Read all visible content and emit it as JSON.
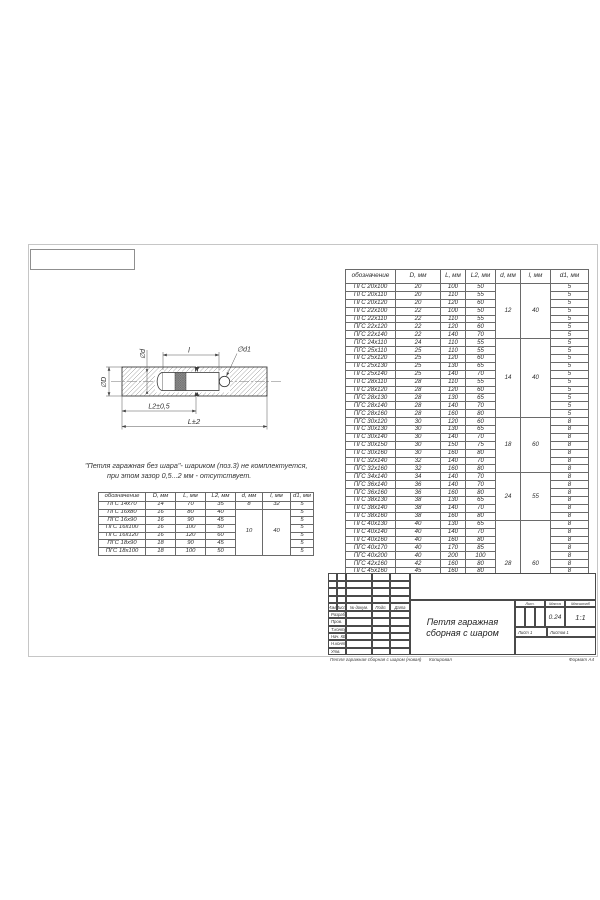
{
  "colors": {
    "line": "#3b3b3b",
    "table_border": "#6a6a6a",
    "hatch": "#8a8a8a",
    "pin_band_fill": "#8f8f8f",
    "sheet_border": "#c6c6c6"
  },
  "drawing": {
    "labels": {
      "dia_d": "∅d",
      "dia_D": "∅D",
      "len_l": "l",
      "dia_d1": "∅d1",
      "l2_dim": "L2±0,5",
      "l_dim": "L±2"
    }
  },
  "note": {
    "line1": "\"Петля гаражная без шара\"- шариком (поз.3) не комплектуется,",
    "line2": "при этом зазор 0,5...2 мм - отсутствует."
  },
  "small_table": {
    "headers": [
      "обозначение",
      "D, мм",
      "L, мм",
      "L2, мм",
      "d, мм",
      "l, мм",
      "d1, мм"
    ],
    "groups": [
      {
        "d": "8",
        "l": "32",
        "rows": [
          [
            "ПГС 14х70",
            "14",
            "70",
            "35",
            "5"
          ]
        ]
      },
      {
        "d": "10",
        "l": "40",
        "rows": [
          [
            "ПГС 16х80",
            "16",
            "80",
            "40",
            "5"
          ],
          [
            "ПГС 16х90",
            "16",
            "90",
            "45",
            "5"
          ],
          [
            "ПГС 16х100",
            "16",
            "100",
            "50",
            "5"
          ],
          [
            "ПГС 16х120",
            "16",
            "120",
            "60",
            "5"
          ],
          [
            "ПГС 18х90",
            "18",
            "90",
            "45",
            "5"
          ],
          [
            "ПГС 18х100",
            "18",
            "100",
            "50",
            "5"
          ]
        ]
      }
    ]
  },
  "main_table": {
    "headers": [
      "обозначение",
      "D, мм",
      "L, мм",
      "L2, мм",
      "d, мм",
      "l, мм",
      "d1, мм"
    ],
    "groups": [
      {
        "d": "12",
        "l": "40",
        "rows": [
          [
            "ПГС 20х100",
            "20",
            "100",
            "50",
            "5"
          ],
          [
            "ПГС 20х110",
            "20",
            "110",
            "55",
            "5"
          ],
          [
            "ПГС 20х120",
            "20",
            "120",
            "60",
            "5"
          ],
          [
            "ПГС 22х100",
            "22",
            "100",
            "50",
            "5"
          ],
          [
            "ПГС 22х110",
            "22",
            "110",
            "55",
            "5"
          ],
          [
            "ПГС 22х120",
            "22",
            "120",
            "60",
            "5"
          ],
          [
            "ПГС 22х140",
            "22",
            "140",
            "70",
            "5"
          ]
        ]
      },
      {
        "d": "14",
        "l": "40",
        "rows": [
          [
            "ПГС 24х110",
            "24",
            "110",
            "55",
            "5"
          ],
          [
            "ПГС 25х110",
            "25",
            "110",
            "55",
            "5"
          ],
          [
            "ПГС 25х120",
            "25",
            "120",
            "60",
            "5"
          ],
          [
            "ПГС 25х130",
            "25",
            "130",
            "65",
            "5"
          ],
          [
            "ПГС 25х140",
            "25",
            "140",
            "70",
            "5"
          ],
          [
            "ПГС 28х110",
            "28",
            "110",
            "55",
            "5"
          ],
          [
            "ПГС 28х120",
            "28",
            "120",
            "60",
            "5"
          ],
          [
            "ПГС 28х130",
            "28",
            "130",
            "65",
            "5"
          ],
          [
            "ПГС 28х140",
            "28",
            "140",
            "70",
            "5"
          ],
          [
            "ПГС 28х160",
            "28",
            "160",
            "80",
            "5"
          ]
        ]
      },
      {
        "d": "18",
        "l": "60",
        "rows": [
          [
            "ПГС 30х120",
            "30",
            "120",
            "60",
            "8"
          ],
          [
            "ПГС 30х130",
            "30",
            "130",
            "65",
            "8"
          ],
          [
            "ПГС 30х140",
            "30",
            "140",
            "70",
            "8"
          ],
          [
            "ПГС 30х150",
            "30",
            "150",
            "75",
            "8"
          ],
          [
            "ПГС 30х160",
            "30",
            "160",
            "80",
            "8"
          ],
          [
            "ПГС 32х140",
            "32",
            "140",
            "70",
            "8"
          ],
          [
            "ПГС 32х160",
            "32",
            "160",
            "80",
            "8"
          ]
        ]
      },
      {
        "d": "24",
        "l": "55",
        "rows": [
          [
            "ПГС 34х140",
            "34",
            "140",
            "70",
            "8"
          ],
          [
            "ПГС 36х140",
            "36",
            "140",
            "70",
            "8"
          ],
          [
            "ПГС 36х160",
            "36",
            "160",
            "80",
            "8"
          ],
          [
            "ПГС 38х130",
            "38",
            "130",
            "65",
            "8"
          ],
          [
            "ПГС 38х140",
            "38",
            "140",
            "70",
            "8"
          ],
          [
            "ПГС 38х160",
            "38",
            "160",
            "80",
            "8"
          ]
        ]
      },
      {
        "d": "28",
        "l": "60",
        "rows": [
          [
            "ПГС 40х130",
            "40",
            "130",
            "65",
            "8"
          ],
          [
            "ПГС 40х140",
            "40",
            "140",
            "70",
            "8"
          ],
          [
            "ПГС 40х160",
            "40",
            "160",
            "80",
            "8"
          ],
          [
            "ПГС 40х170",
            "40",
            "170",
            "85",
            "8"
          ],
          [
            "ПГС 40х200",
            "40",
            "200",
            "100",
            "8"
          ],
          [
            "ПГС 42х160",
            "42",
            "160",
            "80",
            "8"
          ],
          [
            "ПГС 45х160",
            "45",
            "160",
            "80",
            "8"
          ],
          [
            "ПГС 45х180",
            "45",
            "180",
            "90",
            "8"
          ],
          [
            "ПГС 50х160",
            "50",
            "160",
            "80",
            "10"
          ],
          [
            "ПГС 50х180",
            "50",
            "180",
            "90",
            "10"
          ],
          [
            "ПГС 50х200",
            "50",
            "200",
            "100",
            "10"
          ]
        ]
      }
    ]
  },
  "title_block": {
    "doc_title_line1": "Петля гаражная",
    "doc_title_line2": "сборная с шаром",
    "cols": {
      "izm": "Изм.",
      "list": "Лист",
      "ndoc": "№ докум.",
      "podp": "Подп.",
      "data": "Дата"
    },
    "rows": [
      "Разраб.",
      "Пров.",
      "Т.контр.",
      "Нач. КБ",
      "Н.контр.",
      "Утв."
    ],
    "lit_label": "Лит.",
    "mass_label": "Масса",
    "scale_label": "Масштаб",
    "mass_value": "0.24",
    "scale_value": "1:1",
    "sheet_label": "Лист 1",
    "sheets_label": "Листов 1"
  },
  "footer": {
    "file": "Петля гаражная сборная с шаром (новая)",
    "copied": "Копировал",
    "format": "Формат А4"
  }
}
